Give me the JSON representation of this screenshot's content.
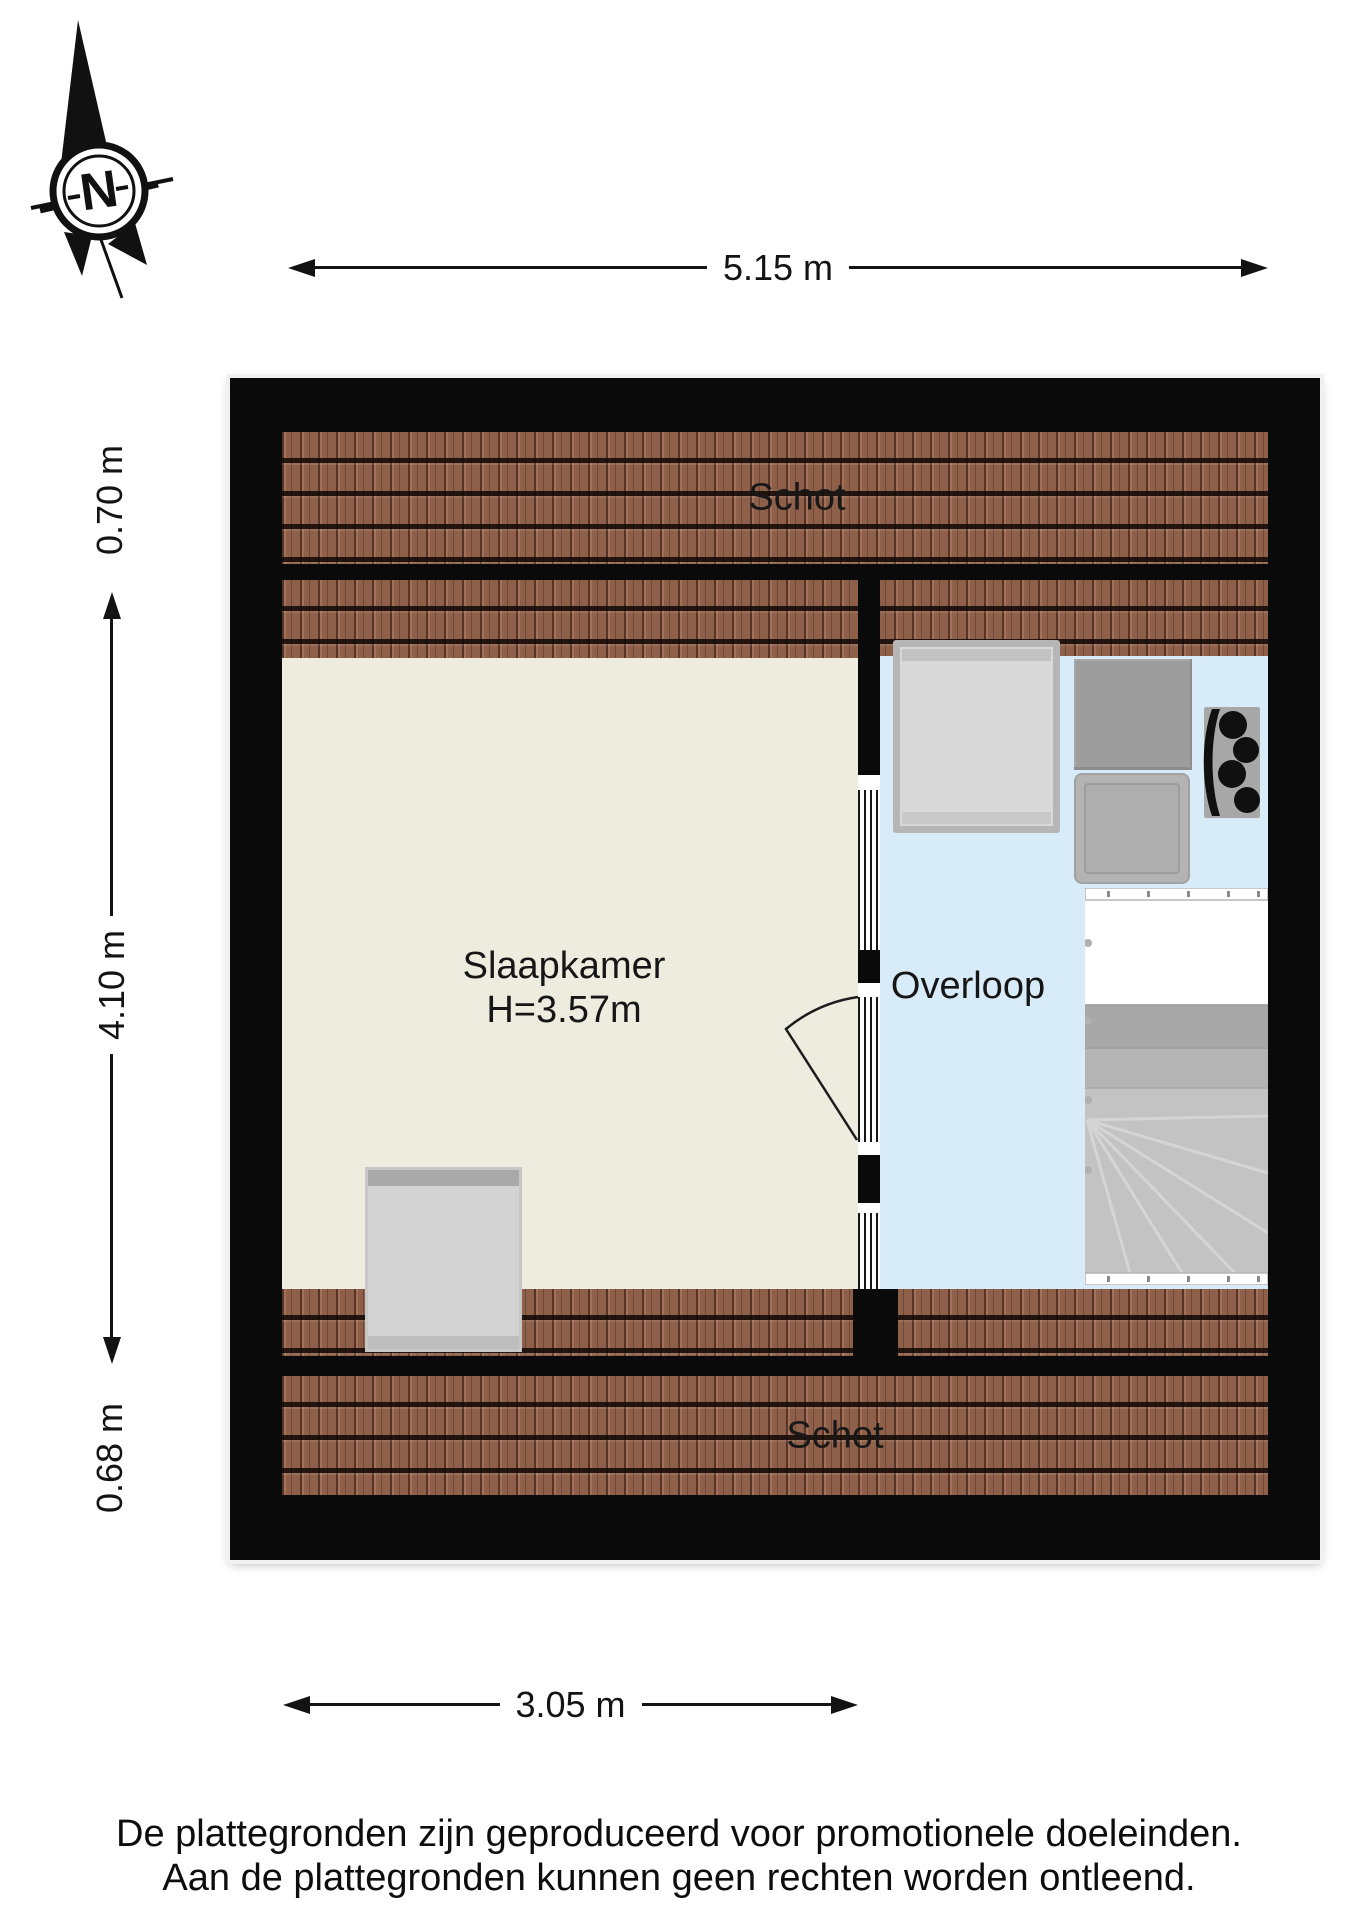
{
  "compass": {
    "label": "N"
  },
  "dimensions": {
    "width_total": "5.15 m",
    "strip_top": "0.70 m",
    "depth_middle": "4.10 m",
    "strip_bottom": "0.68 m",
    "width_bedroom": "3.05 m"
  },
  "floorplan": {
    "labels": {
      "schot_top": "Schot",
      "schot_bottom": "Schot"
    },
    "rooms": [
      {
        "name": "Slaapkamer",
        "ceiling_height": "H=3.57m",
        "floor_color": "#edecdf"
      },
      {
        "name": "Overloop",
        "floor_color": "#d7ebf8"
      }
    ],
    "colors": {
      "wall": "#0a0a0a",
      "roof_tiles": "#8e604a",
      "furniture": "#d3d3d3",
      "stairs": "#c3c3c3"
    }
  },
  "footer": {
    "line1": "De plattegronden zijn geproduceerd voor promotionele doeleinden.",
    "line2": "Aan de plattegronden kunnen geen rechten worden ontleend."
  }
}
